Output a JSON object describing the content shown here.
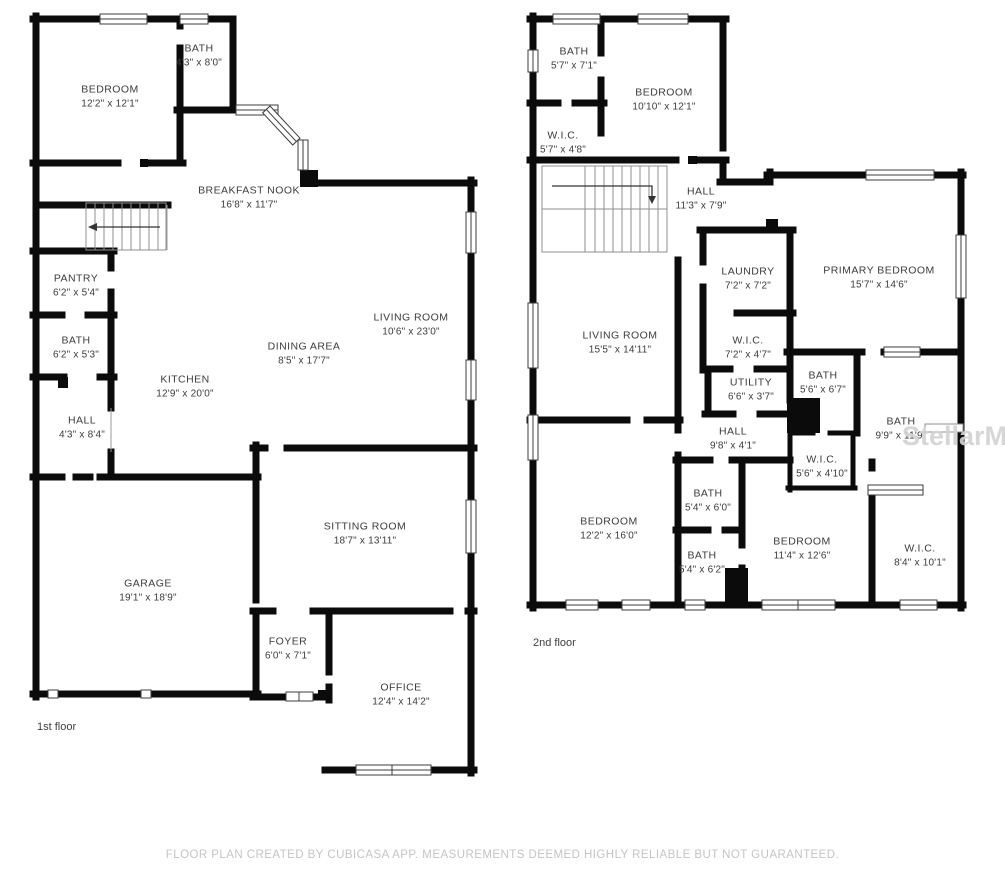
{
  "page": {
    "footer_disclaimer": "FLOOR PLAN CREATED BY CUBICASA APP. MEASUREMENTS DEEMED HIGHLY RELIABLE BUT NOT GUARANTEED.",
    "watermark": "StellarMLS",
    "wall_color": "#0b0b0b",
    "label_color": "#3b3b3b"
  },
  "floors": [
    {
      "label": "1st floor",
      "label_pos": {
        "x": 37,
        "y": 721
      },
      "rooms": [
        {
          "name": "BEDROOM",
          "dims": "12'2\" x 12'1\"",
          "cx": 110,
          "cy": 97
        },
        {
          "name": "BATH",
          "dims": "4'3\" x 8'0\"",
          "cx": 199,
          "cy": 56
        },
        {
          "name": "BREAKFAST NOOK",
          "dims": "16'8\" x 11'7\"",
          "cx": 249,
          "cy": 198
        },
        {
          "name": "PANTRY",
          "dims": "6'2\" x 5'4\"",
          "cx": 76,
          "cy": 286
        },
        {
          "name": "BATH",
          "dims": "6'2\" x 5'3\"",
          "cx": 76,
          "cy": 348
        },
        {
          "name": "HALL",
          "dims": "4'3\" x 8'4\"",
          "cx": 82,
          "cy": 428
        },
        {
          "name": "KITCHEN",
          "dims": "12'9\" x 20'0\"",
          "cx": 185,
          "cy": 387
        },
        {
          "name": "DINING AREA",
          "dims": "8'5\" x 17'7\"",
          "cx": 304,
          "cy": 354
        },
        {
          "name": "LIVING ROOM",
          "dims": "10'6\" x 23'0\"",
          "cx": 411,
          "cy": 325
        },
        {
          "name": "GARAGE",
          "dims": "19'1\" x 18'9\"",
          "cx": 148,
          "cy": 591
        },
        {
          "name": "SITTING ROOM",
          "dims": "18'7\" x 13'11\"",
          "cx": 365,
          "cy": 534
        },
        {
          "name": "FOYER",
          "dims": "6'0\" x 7'1\"",
          "cx": 288,
          "cy": 649
        },
        {
          "name": "OFFICE",
          "dims": "12'4\" x 14'2\"",
          "cx": 401,
          "cy": 695
        }
      ]
    },
    {
      "label": "2nd floor",
      "label_pos": {
        "x": 533,
        "y": 637
      },
      "rooms": [
        {
          "name": "BATH",
          "dims": "5'7\" x 7'1\"",
          "cx": 574,
          "cy": 59
        },
        {
          "name": "BEDROOM",
          "dims": "10'10\" x 12'1\"",
          "cx": 664,
          "cy": 100
        },
        {
          "name": "W.I.C.",
          "dims": "5'7\" x 4'8\"",
          "cx": 563,
          "cy": 143
        },
        {
          "name": "HALL",
          "dims": "11'3\" x 7'9\"",
          "cx": 701,
          "cy": 199
        },
        {
          "name": "LAUNDRY",
          "dims": "7'2\" x 7'2\"",
          "cx": 748,
          "cy": 279
        },
        {
          "name": "PRIMARY BEDROOM",
          "dims": "15'7\" x 14'6\"",
          "cx": 879,
          "cy": 278
        },
        {
          "name": "LIVING ROOM",
          "dims": "15'5\" x 14'11\"",
          "cx": 620,
          "cy": 343
        },
        {
          "name": "W.I.C.",
          "dims": "7'2\" x 4'7\"",
          "cx": 748,
          "cy": 348
        },
        {
          "name": "UTILITY",
          "dims": "6'6\" x 3'7\"",
          "cx": 751,
          "cy": 390
        },
        {
          "name": "BATH",
          "dims": "5'6\" x 6'7\"",
          "cx": 823,
          "cy": 383
        },
        {
          "name": "HALL",
          "dims": "9'8\" x 4'1\"",
          "cx": 733,
          "cy": 439
        },
        {
          "name": "BATH",
          "dims": "9'9\" x 11'9\"",
          "cx": 901,
          "cy": 429
        },
        {
          "name": "W.I.C.",
          "dims": "5'6\" x 4'10\"",
          "cx": 822,
          "cy": 467
        },
        {
          "name": "BATH",
          "dims": "5'4\" x 6'0\"",
          "cx": 708,
          "cy": 501
        },
        {
          "name": "BATH",
          "dims": "5'4\" x 6'2\"",
          "cx": 702,
          "cy": 563
        },
        {
          "name": "BEDROOM",
          "dims": "12'2\" x 16'0\"",
          "cx": 609,
          "cy": 529
        },
        {
          "name": "BEDROOM",
          "dims": "11'4\" x 12'6\"",
          "cx": 802,
          "cy": 549
        },
        {
          "name": "W.I.C.",
          "dims": "8'4\" x 10'1\"",
          "cx": 920,
          "cy": 556
        }
      ]
    }
  ]
}
